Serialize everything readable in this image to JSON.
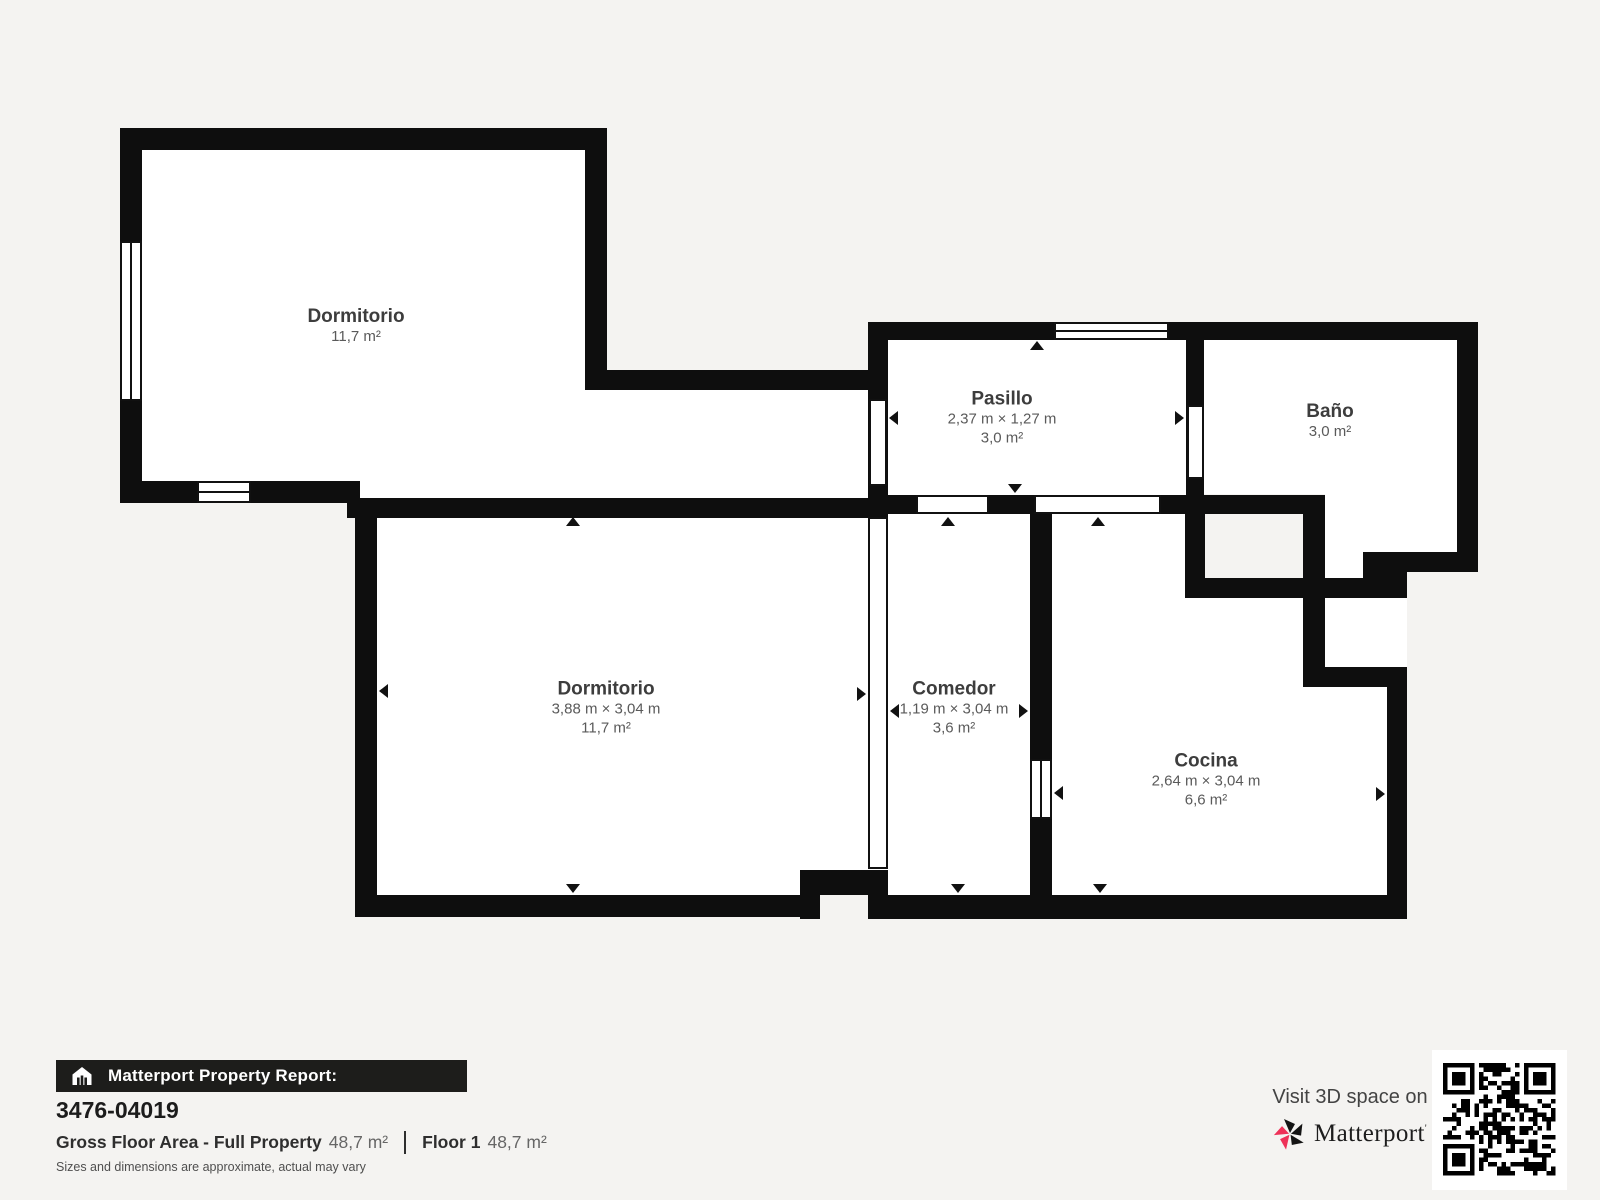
{
  "rooms": [
    {
      "id": "dormitorio-1",
      "name": "Dormitorio",
      "dims": "",
      "area": "11,7 m²"
    },
    {
      "id": "pasillo",
      "name": "Pasillo",
      "dims": "2,37 m × 1,27 m",
      "area": "3,0 m²"
    },
    {
      "id": "bano",
      "name": "Baño",
      "dims": "",
      "area": "3,0 m²"
    },
    {
      "id": "dormitorio-2",
      "name": "Dormitorio",
      "dims": "3,88 m × 3,04 m",
      "area": "11,7 m²"
    },
    {
      "id": "comedor",
      "name": "Comedor",
      "dims": "1,19 m × 3,04 m",
      "area": "3,6 m²"
    },
    {
      "id": "cocina",
      "name": "Cocina",
      "dims": "2,64 m × 3,04 m",
      "area": "6,6 m²"
    }
  ],
  "footer": {
    "report_label": "Matterport Property Report:",
    "report_id": "3476-04019",
    "gross_label": "Gross Floor Area - Full Property",
    "gross_value": "48,7 m²",
    "floor_label": "Floor 1",
    "floor_value": "48,7 m²",
    "disclaimer": "Sizes and dimensions are approximate, actual may vary",
    "visit_label": "Visit 3D space on",
    "brand": "Matterport"
  },
  "icons": {
    "home_icon": "house-scan",
    "logo_icon": "matterport-pinwheel",
    "qr_code": "qr-code"
  },
  "colors": {
    "wall": "#0e0e0e",
    "background": "#f4f3f1",
    "room_floor": "#ffffff",
    "accent": "#ee3158",
    "bar_background": "#1d1d1b"
  }
}
